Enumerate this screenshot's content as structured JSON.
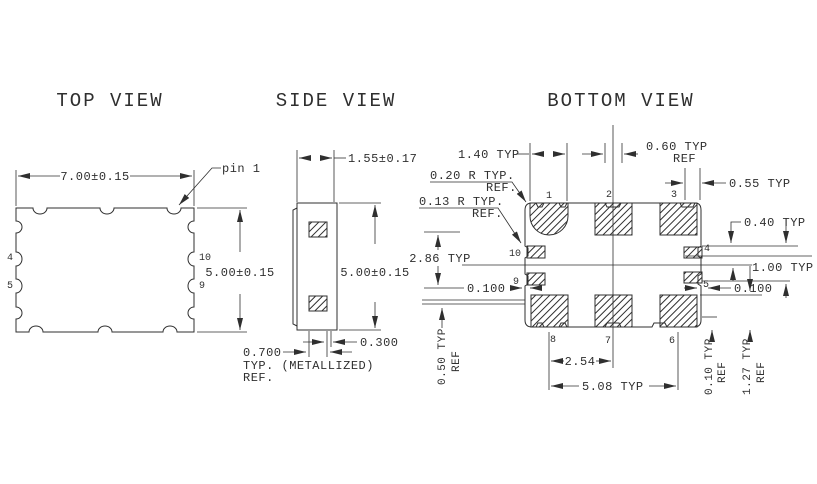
{
  "titles": {
    "top_view": "TOP VIEW",
    "side_view": "SIDE VIEW",
    "bottom_view": "BOTTOM VIEW"
  },
  "colors": {
    "line": "#2f2f2f",
    "background": "#ffffff"
  },
  "top_view": {
    "dim_width": "7.00±0.15",
    "dim_height": "5.00±0.15",
    "pin1_callout": "pin 1",
    "pin_4": "4",
    "pin_5": "5",
    "pin_10": "10",
    "pin_9": "9"
  },
  "side_view": {
    "dim_thickness": "1.55±0.17",
    "dim_height": "5.00±0.15",
    "dim_edge_gap": "0.300",
    "dim_pad_width": "0.700",
    "metallized_note": "TYP. (METALLIZED)",
    "metallized_ref": "REF."
  },
  "bottom_view": {
    "dim_pad_width": "1.40 TYP",
    "dim_notch_center": "0.60 TYP",
    "dim_notch_center_ref": "REF",
    "dim_notch_corner": "0.55 TYP",
    "radius_outer": "0.20 R TYP.",
    "radius_outer_ref": "REF.",
    "radius_inner": "0.13 R TYP.",
    "radius_inner_ref": "REF.",
    "dim_side_span": "2.86 TYP",
    "dim_edge_left": "0.100",
    "dim_top_offset": "0.40 TYP",
    "dim_side_pitch": "1.00 TYP",
    "dim_edge_right": "0.100",
    "dim_seal": "0.50 TYP",
    "dim_seal_ref": "REF",
    "dim_pad_inset": "0.10 TYP",
    "dim_pad_inset_ref": "REF",
    "dim_pad_length": "1.27 TYP",
    "dim_pad_length_ref": "REF",
    "dim_pitch": "2.54",
    "dim_span": "5.08 TYP",
    "pads": {
      "p1": "1",
      "p2": "2",
      "p3": "3",
      "p4": "4",
      "p5": "5",
      "p6": "6",
      "p7": "7",
      "p8": "8",
      "p9": "9",
      "p10": "10"
    }
  }
}
